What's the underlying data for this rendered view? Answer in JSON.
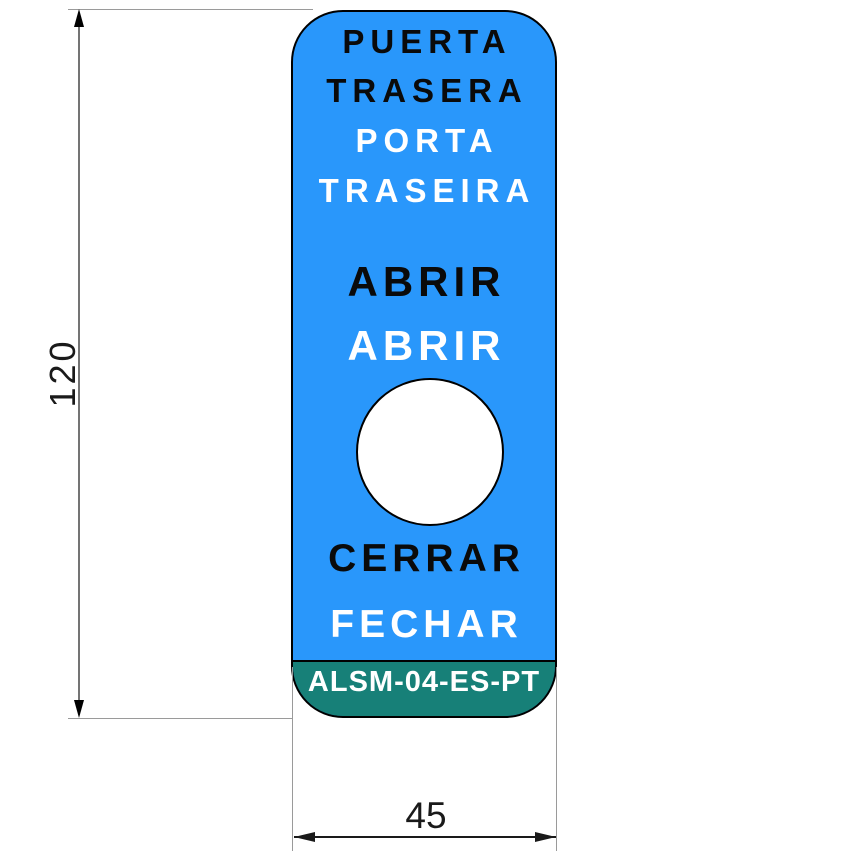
{
  "colors": {
    "label_blue": "#2997FB",
    "band_teal": "#178078",
    "outline_black": "#000000",
    "dim_line_gray": "#747474",
    "ext_line_gray": "#9A9A9A",
    "dim_text_dark": "#1A1A1A",
    "text_black": "#0A0A0A",
    "text_white": "#FFFFFF"
  },
  "label": {
    "door_es_line1": "PUERTA",
    "door_es_line2": "TRASERA",
    "door_pt_line1": "PORTA",
    "door_pt_line2": "TRASEIRA",
    "open_es": "ABRIR",
    "open_pt": "ABRIR",
    "close_es": "CERRAR",
    "close_pt": "FECHAR",
    "part_code": "ALSM-04-ES-PT"
  },
  "dimensions": {
    "height_mm": "120",
    "width_mm": "45"
  }
}
